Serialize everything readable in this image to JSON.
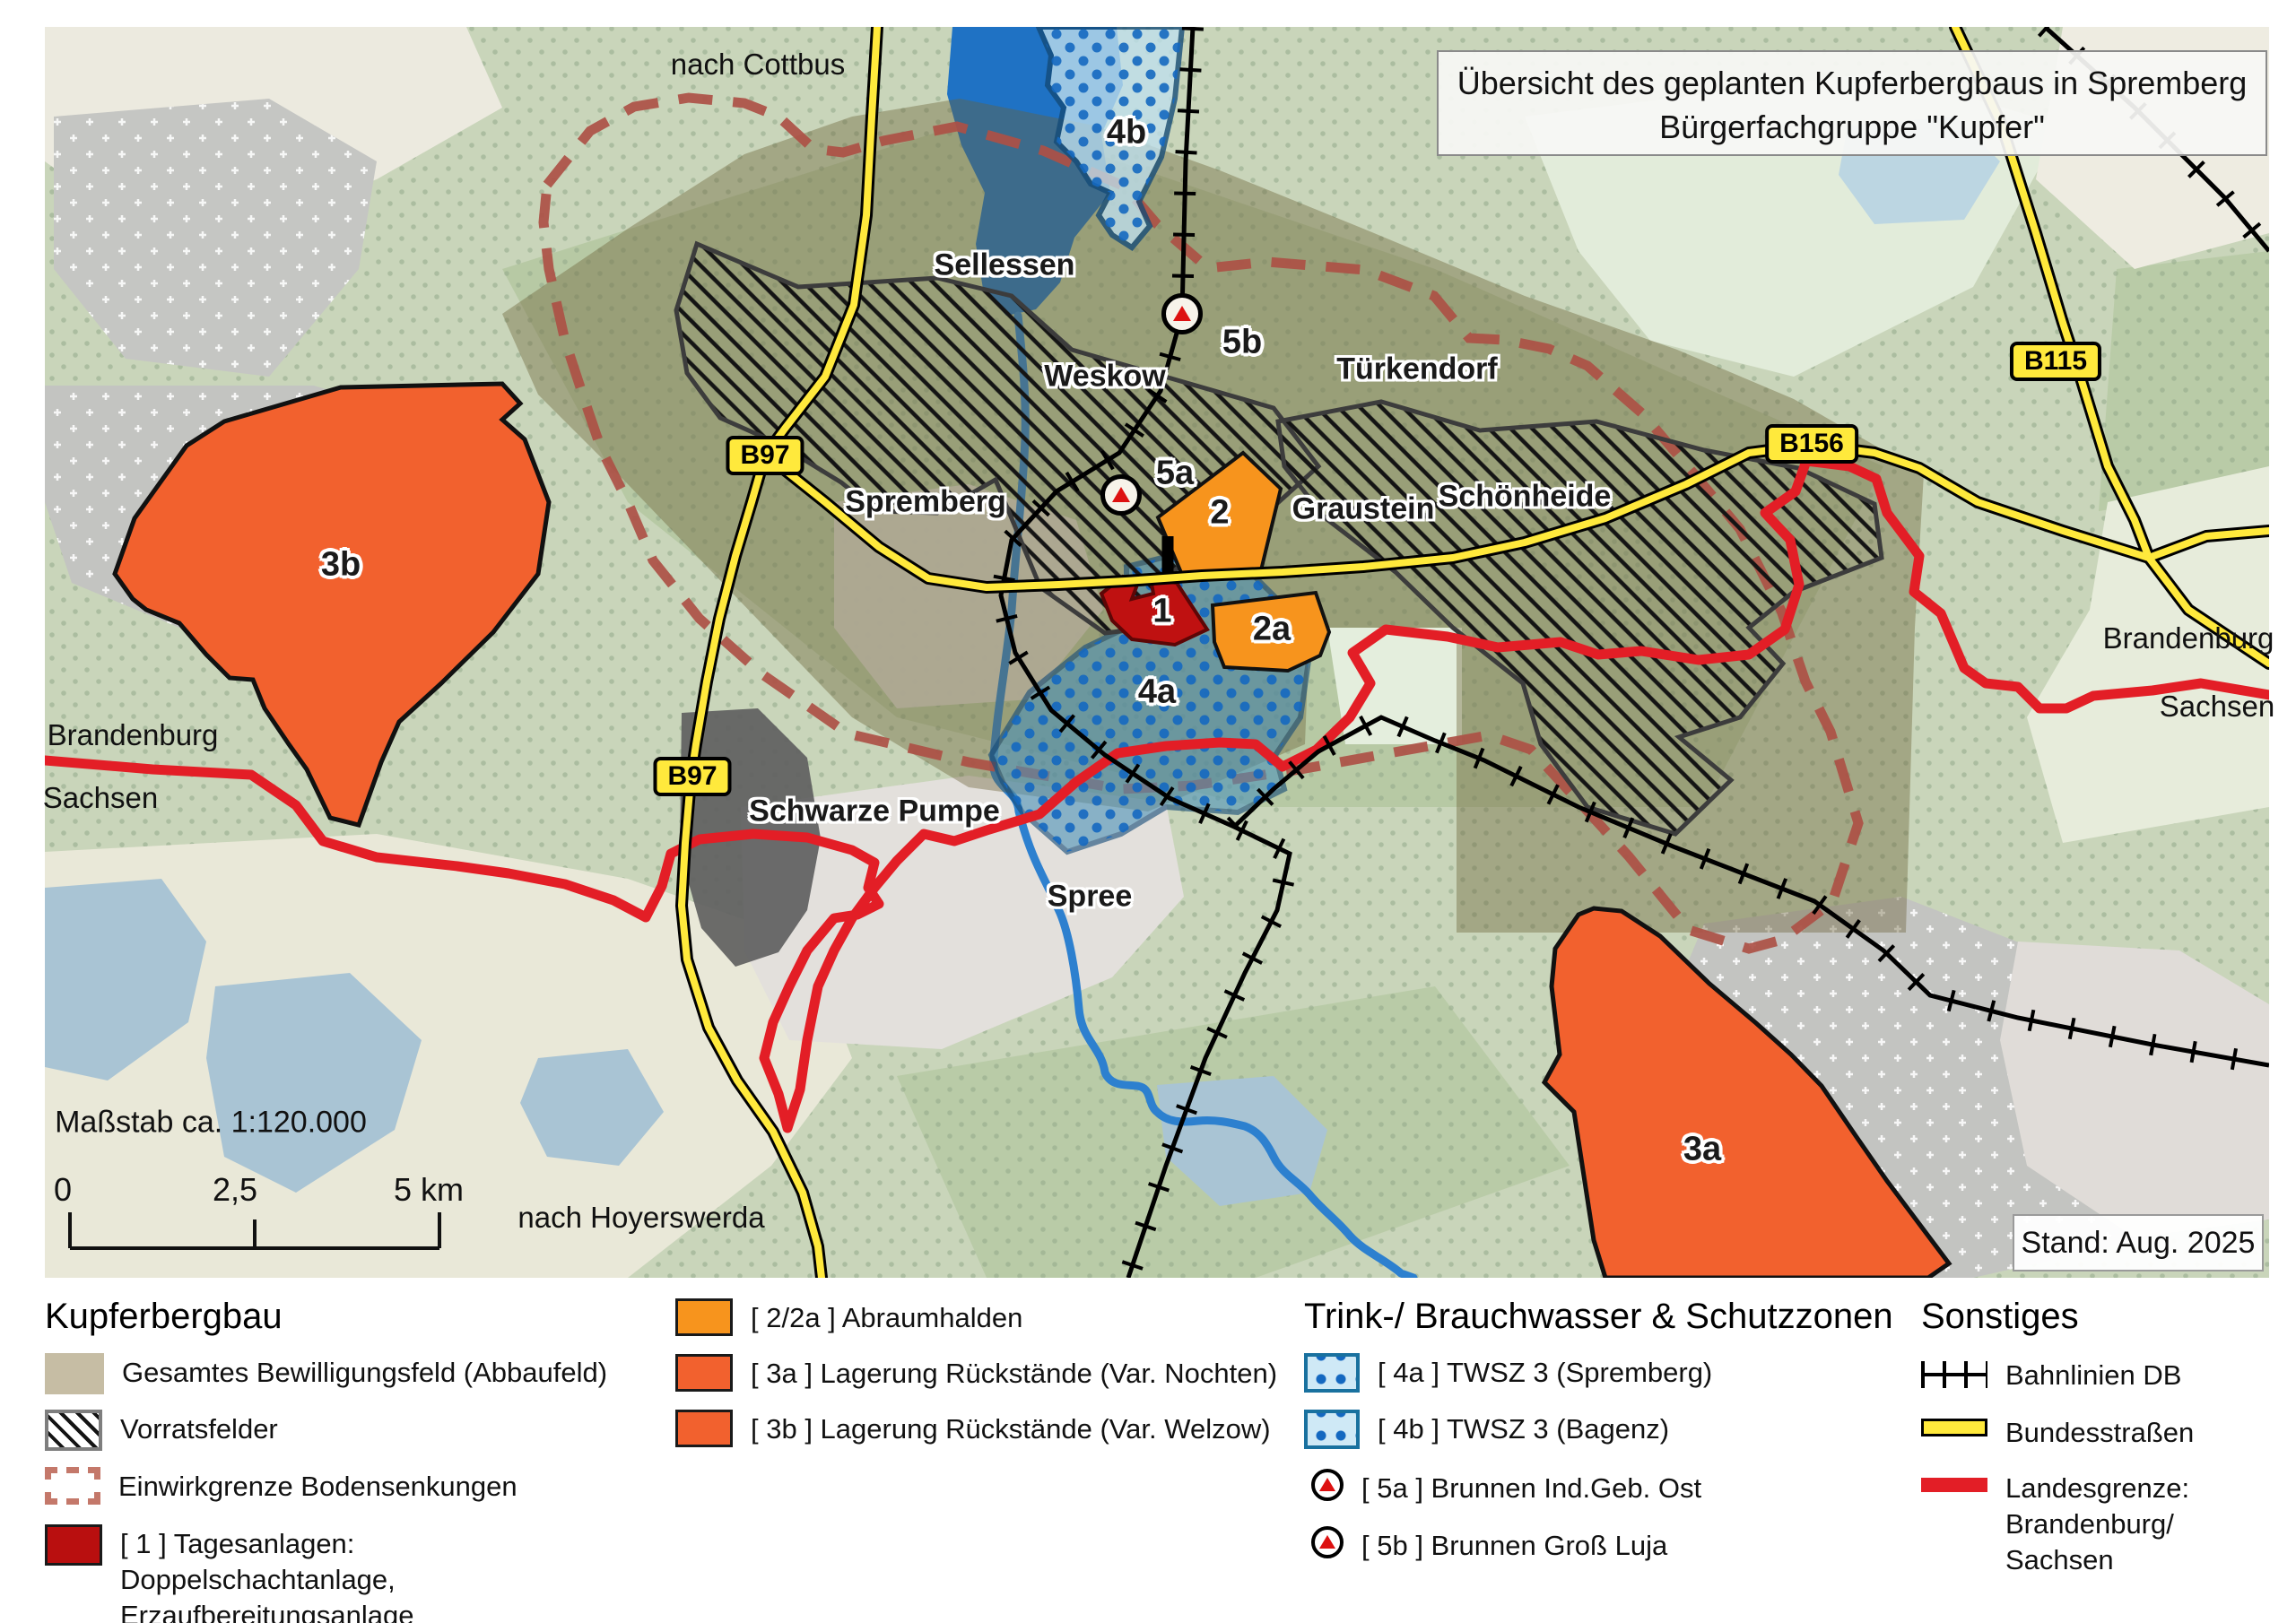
{
  "title": {
    "line1": "Übersicht des geplanten Kupferbergbaus in Spremberg",
    "line2": "Bürgerfachgruppe \"Kupfer\""
  },
  "stand_badge": "Stand: Aug. 2025",
  "map": {
    "labels": [
      {
        "id": "nach-cottbus",
        "text": "nach Cottbus"
      },
      {
        "id": "sellessen",
        "text": "Sellessen"
      },
      {
        "id": "twsz-4b",
        "text": "4b"
      },
      {
        "id": "brunnen-5b",
        "text": "5b"
      },
      {
        "id": "weskow",
        "text": "Weskow"
      },
      {
        "id": "tuerkendorf",
        "text": "Türkendorf"
      },
      {
        "id": "spremberg",
        "text": "Spremberg"
      },
      {
        "id": "brunnen-5a",
        "text": "5a"
      },
      {
        "id": "halde-2",
        "text": "2"
      },
      {
        "id": "graustein",
        "text": "Graustein"
      },
      {
        "id": "schoenheide",
        "text": "Schönheide"
      },
      {
        "id": "rueckstaende-3b",
        "text": "3b"
      },
      {
        "id": "halde-2a",
        "text": "2a"
      },
      {
        "id": "tagesanlagen-1",
        "text": "1"
      },
      {
        "id": "twsz-4a",
        "text": "4a"
      },
      {
        "id": "brandenburg-right",
        "text": "Brandenburg"
      },
      {
        "id": "sachsen-right",
        "text": "Sachsen"
      },
      {
        "id": "brandenburg-left",
        "text": "Brandenburg"
      },
      {
        "id": "sachsen-left",
        "text": "Sachsen"
      },
      {
        "id": "schwarze-pumpe",
        "text": "Schwarze Pumpe"
      },
      {
        "id": "spree",
        "text": "Spree"
      },
      {
        "id": "massstab",
        "text": "Maßstab ca. 1:120.000"
      },
      {
        "id": "scale-0",
        "text": "0"
      },
      {
        "id": "scale-25",
        "text": "2,5"
      },
      {
        "id": "scale-5km",
        "text": "5 km"
      },
      {
        "id": "nach-hoyerswerda",
        "text": "nach Hoyerswerda"
      },
      {
        "id": "rueckstaende-3a",
        "text": "3a"
      }
    ],
    "shields": [
      {
        "text": "B97"
      },
      {
        "text": "B97"
      },
      {
        "text": "B156"
      },
      {
        "text": "B115"
      }
    ],
    "colors": {
      "abraumhalde_orange": "#f7941d",
      "rueckstaende_orangered": "#f2612e",
      "tagesanlagen_darkred": "#b90f0f",
      "bewilligungsfeld_tan": "#c6bda4",
      "einwirkgrenze_rust": "#ad5045",
      "twsz_blue_border": "#19719f",
      "bundesstrasse_yellow": "#ffe93c",
      "landesgrenze_red": "#e31e26"
    }
  },
  "legend": {
    "sections": [
      {
        "title": "Kupferbergbau",
        "items": [
          {
            "label": "Gesamtes Bewilligungsfeld (Abbaufeld)"
          },
          {
            "label": "Vorratsfelder"
          },
          {
            "label": "Einwirkgrenze Bodensenkungen"
          },
          {
            "label": "[ 1 ] Tagesanlagen: Doppelschachtanlage, Erzaufbereitungsanlage"
          }
        ]
      },
      {
        "title": "",
        "items": [
          {
            "label": "[ 2/2a ] Abraumhalden"
          },
          {
            "label": "[ 3a ] Lagerung Rückstände (Var. Nochten)"
          },
          {
            "label": "[ 3b ] Lagerung Rückstände (Var. Welzow)"
          }
        ]
      },
      {
        "title": "Trink-/ Brauchwasser & Schutzzonen",
        "items": [
          {
            "label": "[ 4a ] TWSZ 3 (Spremberg)"
          },
          {
            "label": "[ 4b ] TWSZ 3 (Bagenz)"
          },
          {
            "label": "[ 5a ] Brunnen Ind.Geb. Ost"
          },
          {
            "label": "[ 5b ] Brunnen Groß Luja"
          }
        ]
      },
      {
        "title": "Sonstiges",
        "items": [
          {
            "label": "Bahnlinien DB"
          },
          {
            "label": "Bundesstraßen"
          },
          {
            "label": "Landesgrenze: Brandenburg/ Sachsen"
          }
        ]
      }
    ]
  }
}
